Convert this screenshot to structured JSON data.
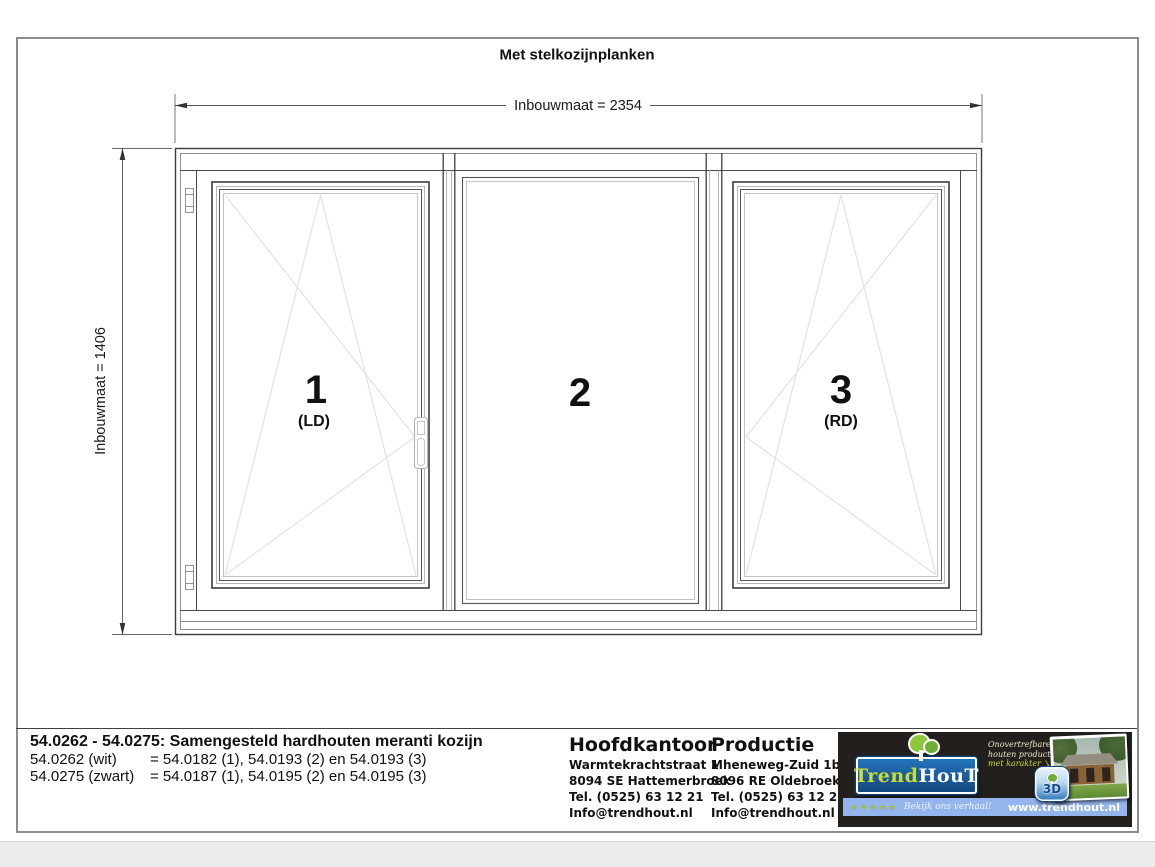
{
  "page": {
    "title": "Met stelkozijnplanken"
  },
  "drawing": {
    "dim_width_label": "Inbouwmaat = 2354",
    "dim_height_label": "Inbouwmaat = 1406",
    "panels": [
      {
        "number": "1",
        "direction": "(LD)"
      },
      {
        "number": "2",
        "direction": ""
      },
      {
        "number": "3",
        "direction": "(RD)"
      }
    ]
  },
  "footer": {
    "title": "54.0262 - 54.0275: Samengesteld hardhouten meranti kozijn",
    "variants": [
      {
        "code": "54.0262 (wit)",
        "composition": "= 54.0182 (1), 54.0193 (2) en 54.0193 (3)"
      },
      {
        "code": "54.0275 (zwart)",
        "composition": "= 54.0187 (1), 54.0195 (2) en 54.0195 (3)"
      }
    ],
    "hoofdkantoor": {
      "title": "Hoofdkantoor",
      "address1": "Warmtekrachtstraat 1",
      "address2": "8094 SE Hattemerbroek",
      "phone": "Tel. (0525) 63 12 21",
      "email": "Info@trendhout.nl"
    },
    "productie": {
      "title": "Productie",
      "address1": "Mheneweg-Zuid 1b",
      "address2": "8096 RE Oldebroek",
      "phone": "Tel. (0525) 63 12 21",
      "email": "Info@trendhout.nl"
    },
    "logo": {
      "brand_trend": "Trend",
      "brand_hout": "HouT",
      "tagline_line1": "Onovertrefbare",
      "tagline_line2": "houten producten",
      "tagline_line3": "met karakter",
      "badge_text": "3D",
      "stars": "★★★★★",
      "review_text": "Bekijk ons verhaal!",
      "website": "www.trendhout.nl",
      "colors": {
        "box_blue": "#1b66ad",
        "lime_green": "#c9dd32",
        "bar_blue": "#94b4ee",
        "panel_black": "#221f1c",
        "tree_green": "#8dc63f"
      }
    }
  }
}
